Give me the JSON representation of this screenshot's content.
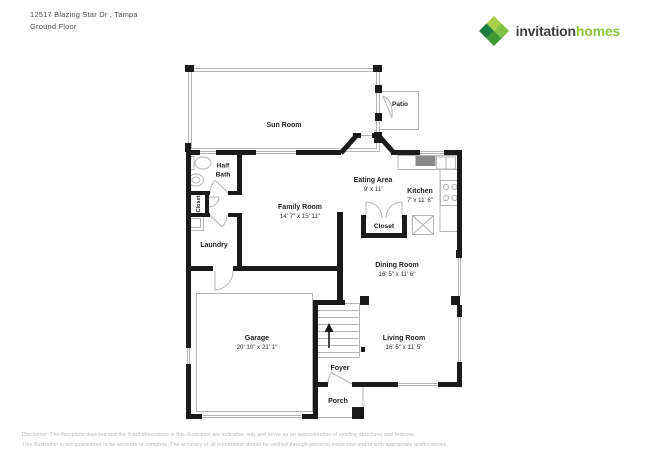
{
  "header": {
    "address_line1": "12517 Blazing Star Dr , Tampa",
    "address_line2": "Ground Floor"
  },
  "logo": {
    "word1": "invitation",
    "word2": "homes",
    "icon": "invitation-homes-leaf-icon"
  },
  "rooms": {
    "sun_room": {
      "label": "Sun Room"
    },
    "patio": {
      "label": "Patio"
    },
    "half_bath": {
      "label_line1": "Half",
      "label_line2": "Bath"
    },
    "closet_left": {
      "label": "Closet"
    },
    "family_room": {
      "label": "Family Room",
      "dims": "14' 7\" x 15' 11\""
    },
    "laundry": {
      "label": "Laundry"
    },
    "eating_area": {
      "label": "Eating Area",
      "dims": "9' x 11'"
    },
    "kitchen": {
      "label": "Kitchen",
      "dims": "7' x 11' 6\""
    },
    "closet_hall": {
      "label": "Closet"
    },
    "dining_room": {
      "label": "Dining Room",
      "dims": "16' 5\" x 11' 6\""
    },
    "garage": {
      "label": "Garage",
      "dims": "20' 10\" x 21' 1\""
    },
    "living_room": {
      "label": "Living Room",
      "dims": "16' 5\" x 11' 5\""
    },
    "foyer": {
      "label": "Foyer"
    },
    "porch": {
      "label": "Porch"
    }
  },
  "footer": {
    "line1": "Disclaimer: The floorplans depicted and the listed dimensions in this illustration are indicative only and serve as an approximation of existing structures and features.",
    "line2": "This illustration is not guaranteed to be accurate or complete. The accuracy of all information should be verified through personal inspection and/or with appropriate professionals."
  },
  "colors": {
    "wall": "#1a1a1a",
    "thin_line": "#b4b4b4",
    "brand_green": "#8dc63f",
    "brand_dark": "#3f3f41",
    "leaf_greens": [
      "#a8cf45",
      "#7dc242",
      "#3f9c35",
      "#1d7d3f"
    ],
    "disclaimer_text": "#b8b8b8"
  }
}
